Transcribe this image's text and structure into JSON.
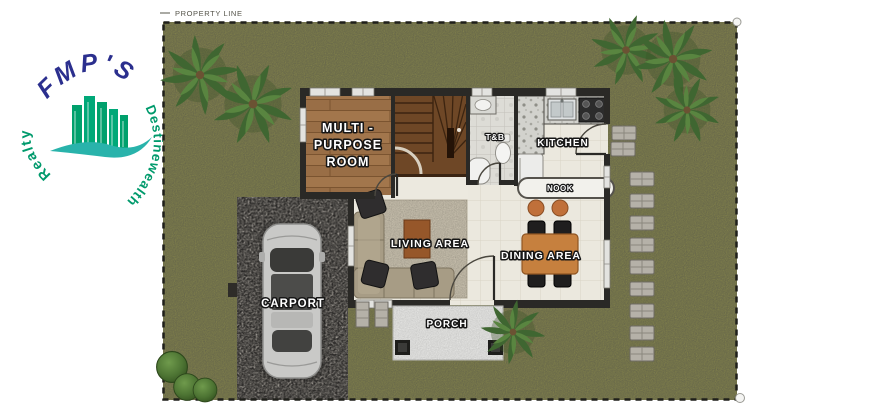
{
  "property": {
    "boundary_label": "PROPERTY LINE"
  },
  "watermark": {
    "top": "FMP'S",
    "right": "Destinewealth",
    "left": "Realty"
  },
  "rooms": {
    "multi_purpose": {
      "lines": [
        "MULTI -",
        "PURPOSE",
        "ROOM"
      ]
    },
    "toilet_bath": {
      "label": "T&B"
    },
    "kitchen": {
      "label": "KITCHEN"
    },
    "nook": {
      "label": "NOOK"
    },
    "living": {
      "label": "LIVING AREA"
    },
    "dining": {
      "label": "DINING AREA"
    },
    "carport": {
      "label": "CARPORT"
    },
    "porch": {
      "label": "PORCH"
    }
  },
  "colors": {
    "grass": "#85854e",
    "gravel": "#a49f98",
    "floor_tile": "#ebe8de",
    "wood": "#a2764c",
    "wall": "#2a2926",
    "stairs": "#6e4726",
    "dining_table": "#c6803e",
    "logo_navy": "#2b2f8e",
    "logo_green": "#009a6c",
    "logo_teal": "#29b3ab"
  }
}
